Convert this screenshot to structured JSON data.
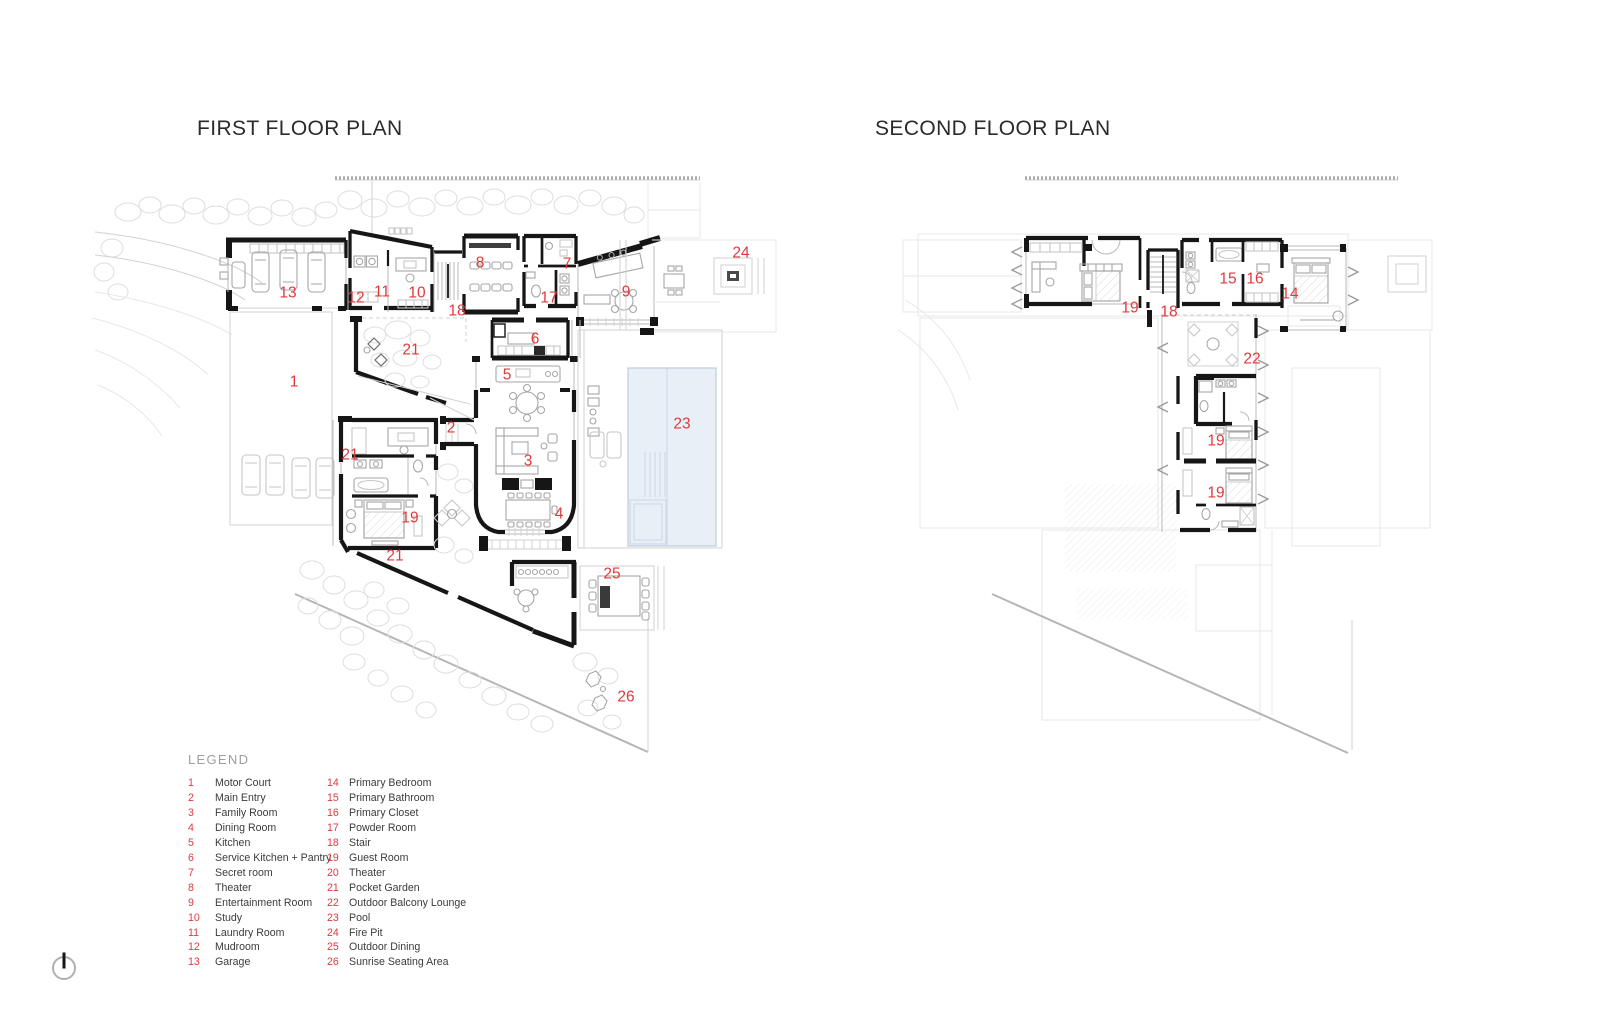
{
  "plans": {
    "first": {
      "title": "FIRST FLOOR PLAN",
      "labels": [
        {
          "n": "1",
          "x": 294,
          "y": 381
        },
        {
          "n": "2",
          "x": 451,
          "y": 427
        },
        {
          "n": "3",
          "x": 528,
          "y": 460
        },
        {
          "n": "4",
          "x": 559,
          "y": 513
        },
        {
          "n": "5",
          "x": 507,
          "y": 374
        },
        {
          "n": "6",
          "x": 535,
          "y": 338
        },
        {
          "n": "7",
          "x": 567,
          "y": 263
        },
        {
          "n": "8",
          "x": 480,
          "y": 262
        },
        {
          "n": "9",
          "x": 626,
          "y": 291
        },
        {
          "n": "10",
          "x": 417,
          "y": 292
        },
        {
          "n": "11",
          "x": 382,
          "y": 291
        },
        {
          "n": "12",
          "x": 356,
          "y": 297
        },
        {
          "n": "13",
          "x": 288,
          "y": 292
        },
        {
          "n": "17",
          "x": 549,
          "y": 297
        },
        {
          "n": "18",
          "x": 457,
          "y": 310
        },
        {
          "n": "19",
          "x": 410,
          "y": 517
        },
        {
          "n": "21",
          "x": 411,
          "y": 349
        },
        {
          "n": "21",
          "x": 350,
          "y": 454
        },
        {
          "n": "21",
          "x": 395,
          "y": 555
        },
        {
          "n": "23",
          "x": 682,
          "y": 423
        },
        {
          "n": "24",
          "x": 741,
          "y": 252
        },
        {
          "n": "25",
          "x": 612,
          "y": 573
        },
        {
          "n": "26",
          "x": 626,
          "y": 696
        }
      ]
    },
    "second": {
      "title": "SECOND FLOOR PLAN",
      "labels": [
        {
          "n": "14",
          "x": 1290,
          "y": 293
        },
        {
          "n": "15",
          "x": 1228,
          "y": 278
        },
        {
          "n": "16",
          "x": 1255,
          "y": 278
        },
        {
          "n": "18",
          "x": 1169,
          "y": 311
        },
        {
          "n": "19",
          "x": 1130,
          "y": 307
        },
        {
          "n": "19",
          "x": 1216,
          "y": 440
        },
        {
          "n": "19",
          "x": 1216,
          "y": 492
        },
        {
          "n": "22",
          "x": 1252,
          "y": 358
        }
      ]
    }
  },
  "legend": {
    "title": "LEGEND",
    "columns": [
      [
        {
          "num": "1",
          "name": "Motor Court"
        },
        {
          "num": "2",
          "name": "Main Entry"
        },
        {
          "num": "3",
          "name": "Family Room"
        },
        {
          "num": "4",
          "name": "Dining Room"
        },
        {
          "num": "5",
          "name": "Kitchen"
        },
        {
          "num": "6",
          "name": "Service Kitchen + Pantry"
        },
        {
          "num": "7",
          "name": "Secret room"
        },
        {
          "num": "8",
          "name": "Theater"
        },
        {
          "num": "9",
          "name": "Entertainment Room"
        },
        {
          "num": "10",
          "name": "Study"
        },
        {
          "num": "11",
          "name": "Laundry Room"
        },
        {
          "num": "12",
          "name": "Mudroom"
        },
        {
          "num": "13",
          "name": "Garage"
        }
      ],
      [
        {
          "num": "14",
          "name": "Primary Bedroom"
        },
        {
          "num": "15",
          "name": "Primary Bathroom"
        },
        {
          "num": "16",
          "name": "Primary Closet"
        },
        {
          "num": "17",
          "name": "Powder Room"
        },
        {
          "num": "18",
          "name": "Stair"
        },
        {
          "num": "19",
          "name": "Guest Room"
        },
        {
          "num": "20",
          "name": "Theater"
        },
        {
          "num": "21",
          "name": "Pocket Garden"
        },
        {
          "num": "22",
          "name": "Outdoor Balcony Lounge"
        },
        {
          "num": "23",
          "name": "Pool"
        },
        {
          "num": "24",
          "name": "Fire Pit"
        },
        {
          "num": "25",
          "name": "Outdoor Dining"
        },
        {
          "num": "26",
          "name": "Sunrise Seating Area"
        }
      ]
    ]
  },
  "compass": {
    "type": "north-arrow"
  },
  "colors": {
    "label_red": "#e0393c",
    "wall_black": "#161616",
    "pool_fill": "#e9eff6",
    "pool_stroke": "#c5d2e0",
    "title_text": "#2b2b2b",
    "legend_header": "#9e9e9e",
    "legend_text": "#3b3b3b"
  }
}
